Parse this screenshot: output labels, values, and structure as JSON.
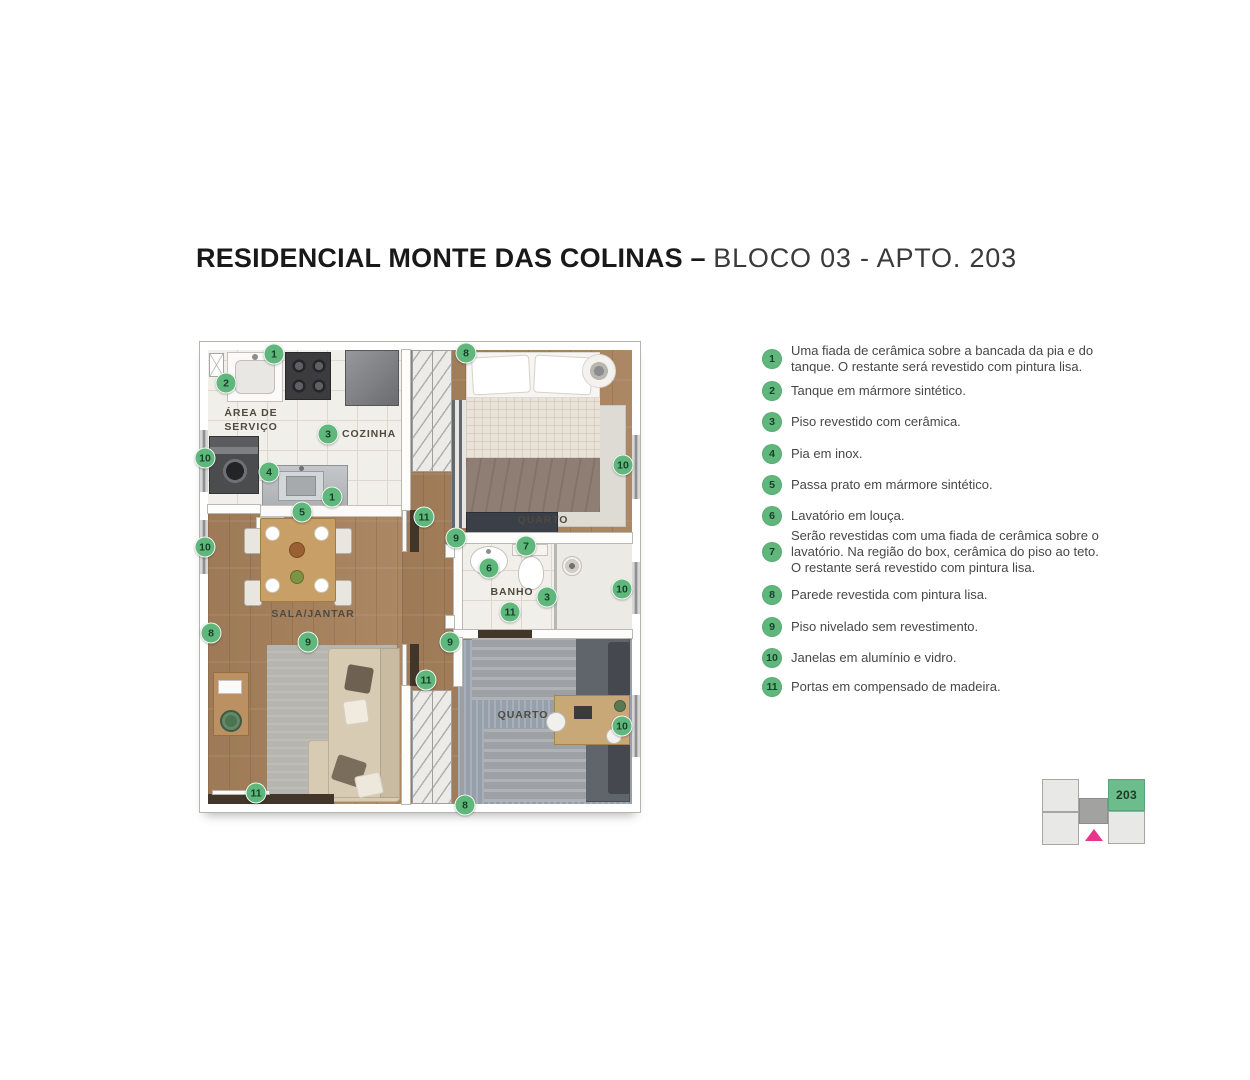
{
  "title": {
    "bold": "RESIDENCIAL MONTE DAS COLINAS –",
    "light": "BLOCO 03 - APTO. 203"
  },
  "colors": {
    "badge_green": "#5fb77c",
    "keyplan_green": "#6cbd8b",
    "keyplan_pink": "#e8358b",
    "wood_floor": "#a7815c",
    "tile_floor": "#f1efe9"
  },
  "plan": {
    "rooms": {
      "service": "ÁREA DE\nSERVIÇO",
      "kitchen": "COZINHA",
      "living": "SALA/JANTAR",
      "bedroom1": "QUARTO",
      "bath": "BANHO",
      "bedroom2": "QUARTO"
    },
    "badges": [
      {
        "n": "1",
        "x": 66,
        "y": 4
      },
      {
        "n": "2",
        "x": 18,
        "y": 33
      },
      {
        "n": "3",
        "x": 120,
        "y": 84
      },
      {
        "n": "10",
        "x": -3,
        "y": 108
      },
      {
        "n": "4",
        "x": 61,
        "y": 122
      },
      {
        "n": "1",
        "x": 124,
        "y": 147
      },
      {
        "n": "5",
        "x": 94,
        "y": 162
      },
      {
        "n": "10",
        "x": -3,
        "y": 197
      },
      {
        "n": "8",
        "x": 3,
        "y": 283
      },
      {
        "n": "9",
        "x": 100,
        "y": 292
      },
      {
        "n": "11",
        "x": 48,
        "y": 443
      },
      {
        "n": "8",
        "x": 258,
        "y": 3
      },
      {
        "n": "11",
        "x": 216,
        "y": 167
      },
      {
        "n": "9",
        "x": 248,
        "y": 188
      },
      {
        "n": "7",
        "x": 318,
        "y": 196
      },
      {
        "n": "6",
        "x": 281,
        "y": 218
      },
      {
        "n": "10",
        "x": 415,
        "y": 115
      },
      {
        "n": "3",
        "x": 339,
        "y": 247
      },
      {
        "n": "10",
        "x": 414,
        "y": 239
      },
      {
        "n": "11",
        "x": 302,
        "y": 262
      },
      {
        "n": "9",
        "x": 242,
        "y": 292
      },
      {
        "n": "11",
        "x": 218,
        "y": 330
      },
      {
        "n": "10",
        "x": 414,
        "y": 376
      },
      {
        "n": "8",
        "x": 257,
        "y": 455
      }
    ]
  },
  "legend": {
    "items": [
      {
        "num": "1",
        "text": "Uma fiada de cerâmica sobre a bancada da pia e do\ntanque. O restante será revestido com pintura lisa."
      },
      {
        "num": "2",
        "text": "Tanque em mármore sintético."
      },
      {
        "num": "3",
        "text": "Piso revestido com cerâmica."
      },
      {
        "num": "4",
        "text": "Pia em inox."
      },
      {
        "num": "5",
        "text": "Passa prato em mármore sintético."
      },
      {
        "num": "6",
        "text": "Lavatório em louça."
      },
      {
        "num": "7",
        "text": "Serão revestidas com uma fiada de cerâmica sobre o\nlavatório. Na região do box, cerâmica do piso ao teto.\nO restante será revestido com pintura lisa."
      },
      {
        "num": "8",
        "text": "Parede revestida com pintura lisa."
      },
      {
        "num": "9",
        "text": "Piso nivelado sem revestimento."
      },
      {
        "num": "10",
        "text": "Janelas em alumínio e vidro."
      },
      {
        "num": "11",
        "text": "Portas em compensado de madeira."
      }
    ]
  },
  "keyplan": {
    "unit": "203"
  }
}
